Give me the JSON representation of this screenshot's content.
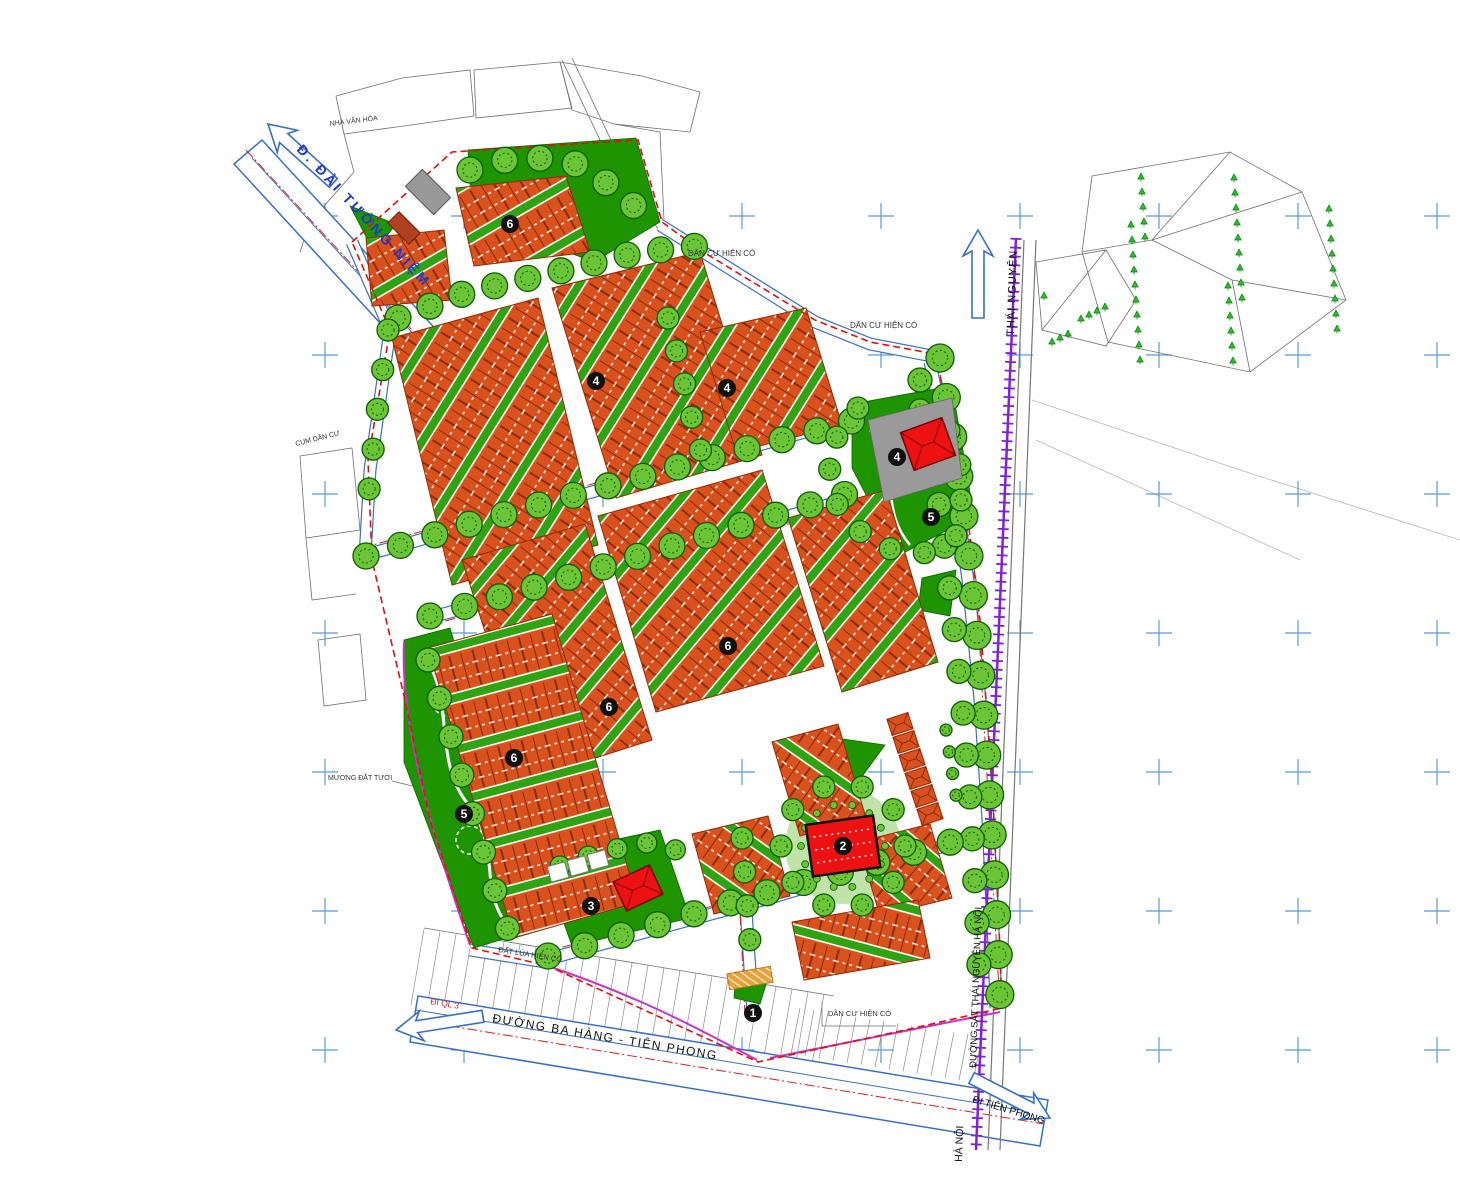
{
  "map": {
    "roads": {
      "dai_tuong_niem": "Đ. ĐÀI TƯỞNG NIỆM",
      "ba_hang_tien_phong": "ĐƯỜNG BA HÀNG - TIÊN PHONG",
      "di_ql3": "ĐI QL 3",
      "di_tien_phong": "ĐI TIÊN PHONG",
      "railway": "ĐƯỜNG SẮT THÁI NGUYÊN HÀ NỘI",
      "to_thai_nguyen": "THÁI NGUYÊN",
      "to_ha_noi": "HÀ NỘI"
    },
    "areas": {
      "dan_cu_1": "DÂN CƯ HIỆN CÓ",
      "dan_cu_2": "DÂN CƯ HIỆN CÓ",
      "dan_cu_3": "DÂN CƯ HIỆN CÓ",
      "nha_van_hoa": "NHÀ VĂN HÓA",
      "cum_dan_cu": "CỤM DÂN CƯ",
      "muong_tuoi": "MƯƠNG ĐẤT TƯỚI",
      "dat_lua": "ĐẤT LÚA HIỆN CÓ"
    },
    "zones": {
      "markers": [
        {
          "number": "6"
        },
        {
          "number": "4"
        },
        {
          "number": "4"
        },
        {
          "number": "4"
        },
        {
          "number": "5"
        },
        {
          "number": "6"
        },
        {
          "number": "6"
        },
        {
          "number": "6"
        },
        {
          "number": "5"
        },
        {
          "number": "2"
        },
        {
          "number": "3"
        },
        {
          "number": "1"
        }
      ]
    },
    "colors": {
      "house": "#D9511D",
      "houseEdge": "#8F2B06",
      "greenStrip": "#2FA312",
      "park": "#1E9400",
      "parkLight": "#BFE3A8",
      "tree": "#6CC437",
      "treeEdge": "#0D5C04",
      "publicRed": "#EE1111",
      "boundary": "#E01010",
      "roadBlue": "#3A6FC0",
      "gridCross": "#5B9BD5",
      "railway": "#7F22D6",
      "survey": "#6F6F6F",
      "canal": "#C238C2",
      "labelBlue": "#2038C8"
    }
  }
}
